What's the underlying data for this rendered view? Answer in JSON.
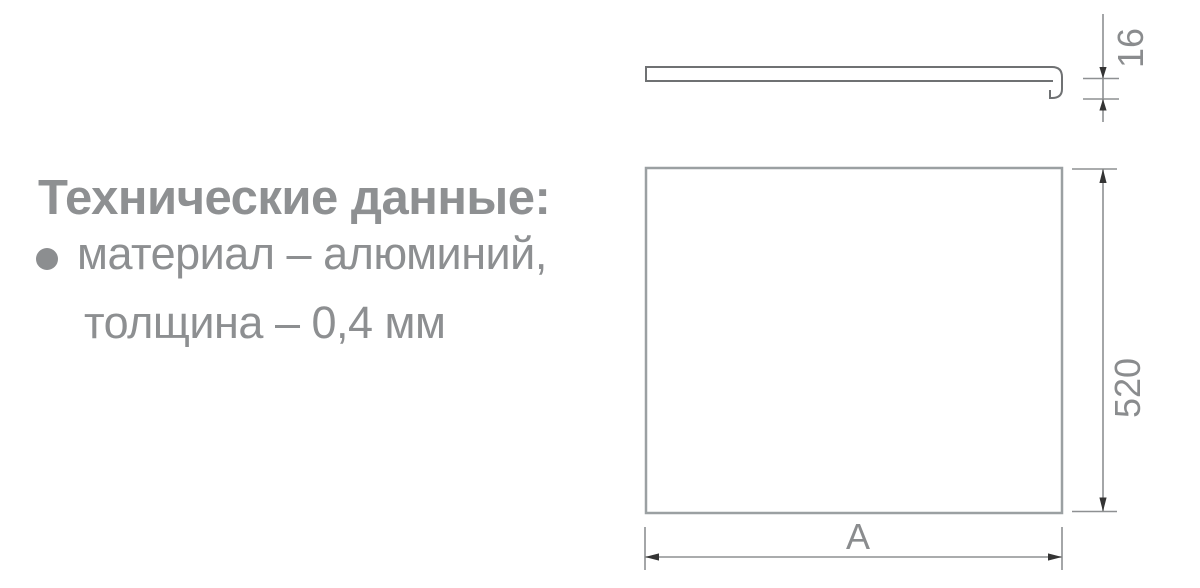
{
  "tech_info": {
    "heading": "Технические данные:",
    "material_line": "материал – алюминий,",
    "thickness_line": "толщина – 0,4 мм"
  },
  "drawing": {
    "side_view_thickness": "16",
    "front_height": "520",
    "front_width": "A"
  },
  "icons": {
    "bullet": "filled-circle"
  },
  "colors": {
    "text_gray": "#8d8f91",
    "heading_gray": "#8e9092",
    "profile_line_gray": "#6f7173",
    "view_line_gray": "#9ba0a2",
    "dimension_line_gray": "#8e9092",
    "dimension_text_gray": "#8a8c8e",
    "arrow_dark": "#343434",
    "background": "#ffffff"
  }
}
